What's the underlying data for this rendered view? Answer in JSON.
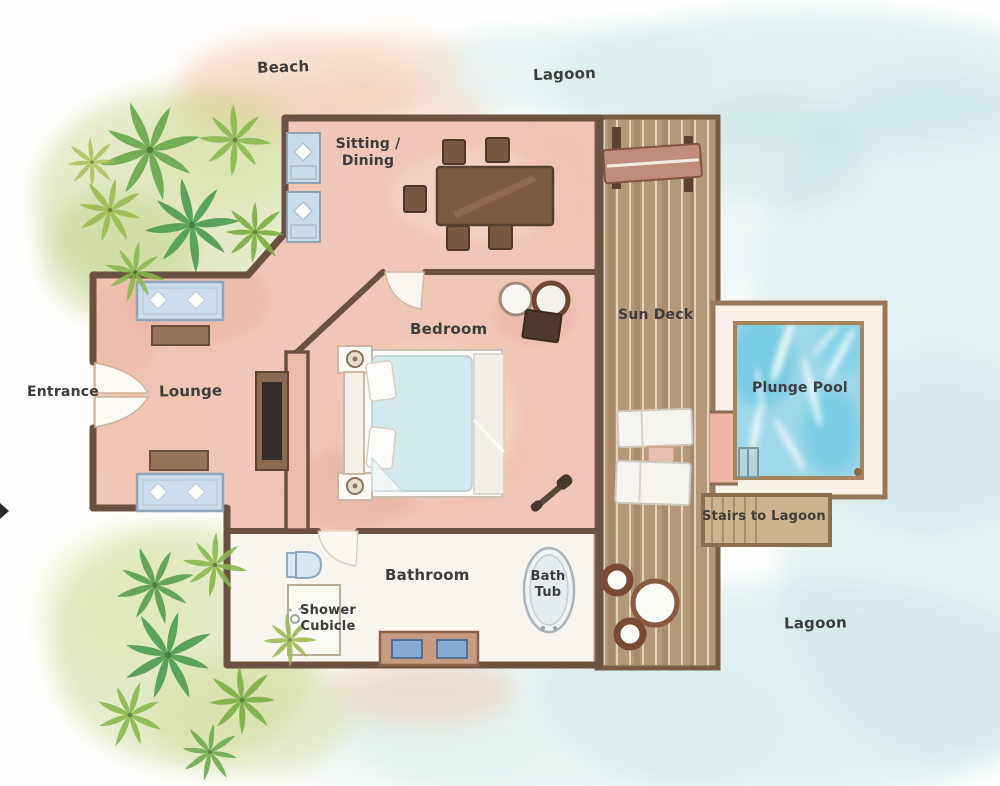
{
  "labels": {
    "beach": "Beach",
    "lagoon_top": "Lagoon",
    "sitting_dining_1": "Sitting /",
    "sitting_dining_2": "Dining",
    "bedroom": "Bedroom",
    "lounge": "Lounge",
    "entrance": "Entrance",
    "sun_deck": "Sun Deck",
    "plunge_pool": "Plunge Pool",
    "stairs_to_lagoon": "Stairs to Lagoon",
    "bathroom": "Bathroom",
    "shower_1": "Shower",
    "shower_2": "Cubicle",
    "bath_tub_1": "Bath",
    "bath_tub_2": "Tub",
    "lagoon_bottom": "Lagoon"
  },
  "palette": {
    "floor_pink": "#f1c6b6",
    "wall_brown": "#6b5140",
    "deck_wood": "#b49878",
    "pool_blue": "#9fd8ea",
    "lagoon_wash": "#cfe8e8",
    "beach_wash": "#f2c6ab",
    "palm_green": "#5aa557",
    "label_ink": "#3d3d3d"
  }
}
